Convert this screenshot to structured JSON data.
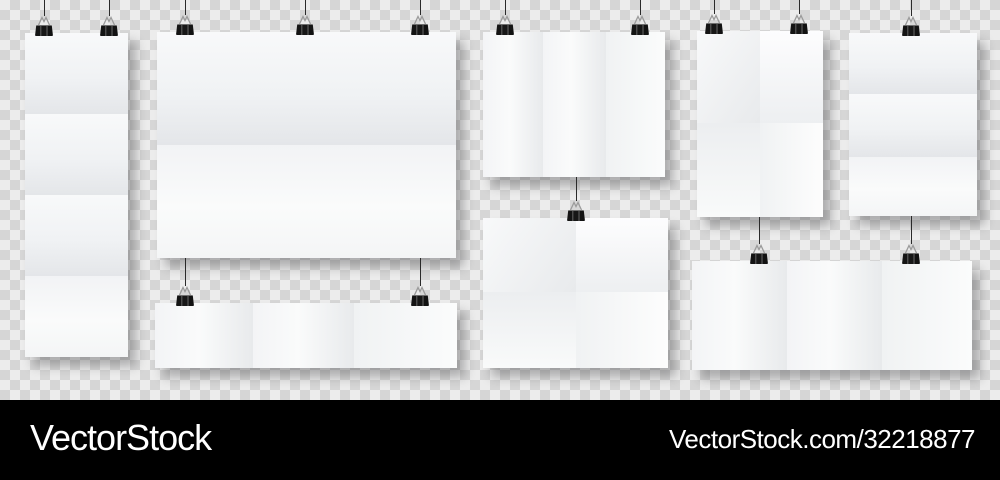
{
  "brand_bar": {
    "logo_text": "VectorStock",
    "site_text": "VectorStock.com/32218877",
    "bg_color": "#000000",
    "text_color": "#ffffff"
  },
  "background": {
    "checker_light": "#ececec",
    "checker_dark": "#d6d6d6",
    "checker_cell_px": 10
  },
  "scene": {
    "posters": [
      {
        "id": "tall-left",
        "x": 25,
        "y": 33,
        "w": 103,
        "h": 324,
        "hfolds": [
          114,
          195,
          276
        ],
        "vfolds": [],
        "clips": [
          44,
          109
        ],
        "strings": [
          {
            "x": 44,
            "y1": 0,
            "y2": 16
          },
          {
            "x": 109,
            "y1": 0,
            "y2": 16
          }
        ]
      },
      {
        "id": "large-center",
        "x": 157,
        "y": 32,
        "w": 299,
        "h": 226,
        "hfolds": [
          145
        ],
        "vfolds": [],
        "clips": [
          185,
          305,
          420
        ],
        "strings": [
          {
            "x": 185,
            "y1": 0,
            "y2": 15
          },
          {
            "x": 305,
            "y1": 0,
            "y2": 15
          },
          {
            "x": 420,
            "y1": 0,
            "y2": 15
          }
        ]
      },
      {
        "id": "wide-strip-center",
        "x": 155,
        "y": 303,
        "w": 302,
        "h": 65,
        "hfolds": [],
        "vfolds": [
          253,
          354
        ],
        "clips": [
          185,
          420
        ],
        "strings": [
          {
            "x": 185,
            "y1": 258,
            "y2": 286
          },
          {
            "x": 420,
            "y1": 258,
            "y2": 286
          }
        ]
      },
      {
        "id": "trifold-top-middle",
        "x": 483,
        "y": 32,
        "w": 182,
        "h": 145,
        "hfolds": [],
        "vfolds": [
          543,
          606
        ],
        "clips": [
          505,
          640
        ],
        "strings": [
          {
            "x": 505,
            "y1": 0,
            "y2": 15
          },
          {
            "x": 640,
            "y1": 0,
            "y2": 15
          }
        ]
      },
      {
        "id": "cross-fold-middle",
        "x": 483,
        "y": 218,
        "w": 185,
        "h": 150,
        "hfolds": [
          292
        ],
        "vfolds": [
          576
        ],
        "clips": [
          576
        ],
        "strings": [
          {
            "x": 576,
            "y1": 177,
            "y2": 201
          }
        ]
      },
      {
        "id": "cross-fold-right-top",
        "x": 697,
        "y": 31,
        "w": 126,
        "h": 186,
        "hfolds": [
          123
        ],
        "vfolds": [
          760
        ],
        "clips": [
          714,
          799
        ],
        "strings": [
          {
            "x": 714,
            "y1": 0,
            "y2": 14
          },
          {
            "x": 799,
            "y1": 0,
            "y2": 14
          }
        ]
      },
      {
        "id": "tall-right",
        "x": 849,
        "y": 33,
        "w": 128,
        "h": 183,
        "hfolds": [
          94,
          157
        ],
        "vfolds": [],
        "clips": [
          911
        ],
        "strings": [
          {
            "x": 911,
            "y1": 0,
            "y2": 16
          }
        ]
      },
      {
        "id": "wide-bottom-right",
        "x": 692,
        "y": 261,
        "w": 280,
        "h": 109,
        "hfolds": [],
        "vfolds": [
          787,
          882
        ],
        "clips": [
          759,
          911
        ],
        "strings": [
          {
            "x": 759,
            "y1": 217,
            "y2": 244
          },
          {
            "x": 911,
            "y1": 216,
            "y2": 244
          }
        ]
      }
    ]
  }
}
